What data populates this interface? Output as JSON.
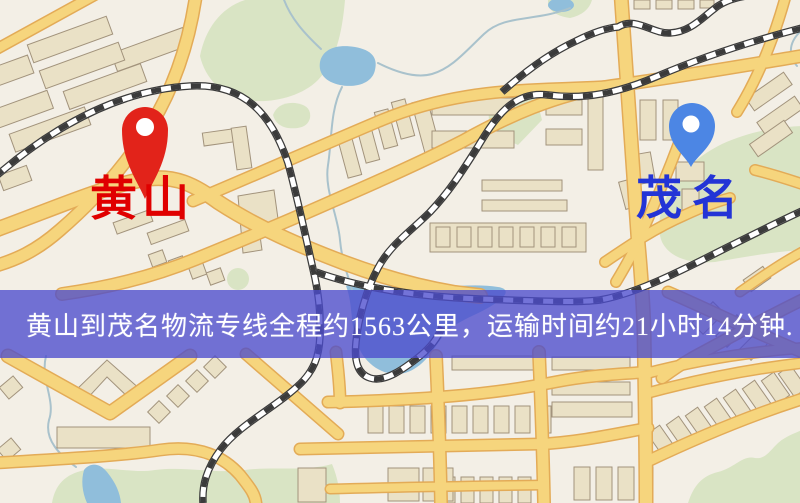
{
  "banner": {
    "text": "黄山到茂名物流专线全程约1563公里，运输时间约21小时14分钟.",
    "background_color": "#4c4ccd",
    "text_color": "#ffffff"
  },
  "markers": {
    "origin": {
      "label": "黄山",
      "pin_color": "#e2231a",
      "label_color": "#e00000"
    },
    "destination": {
      "label": "茂名",
      "pin_color": "#4c86e4",
      "label_color": "#2334d6"
    }
  },
  "route": {
    "distance_km": 1563,
    "duration_hours": 21,
    "duration_minutes": 14
  },
  "map_palette": {
    "background": "#f3efe6",
    "road_fill": "#f6d57d",
    "road_casing": "#e3ab57",
    "railway": "#3b3b3b",
    "green_area": "#d9e4c4",
    "water": "#90bedb",
    "building": "#eae1c6"
  }
}
